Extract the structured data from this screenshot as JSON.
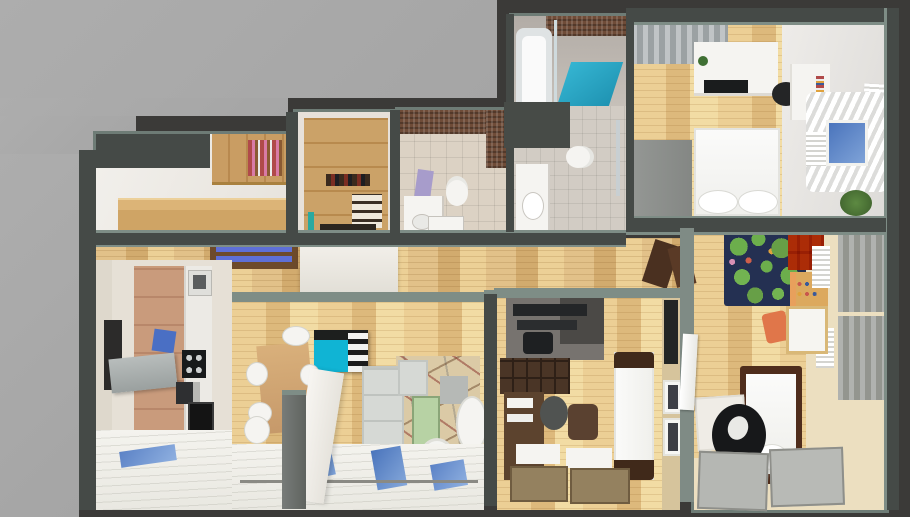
{
  "scene": {
    "title": "Apartment 3D floor plan render",
    "description": "Top-down dollhouse cutaway render of a furnished apartment on a two-tone gray backdrop",
    "projection": "top-down 3D cutaway",
    "image_width": 910,
    "image_height": 517
  },
  "palette": {
    "backdrop_light": "#a9a9a9",
    "backdrop_dark": "#3b3a38",
    "wall": "#454a47",
    "wall_top": "#7e8d86",
    "wood_floor": "#e4c68b",
    "tile_floor": "#d8d0c4",
    "carpet": "#ecdfc0",
    "accent_teal": "#14b2d2",
    "accent_blue": "#4a74bc",
    "accent_orange": "#d8773b",
    "rug_navy": "#243052",
    "sofa_gray": "#d5d8d4",
    "bed_frame_brown": "#4f2d1c",
    "green_table": "#b7d2a4",
    "mosaic_brown": "#6f4c38"
  },
  "rooms": [
    {
      "id": "entry-hall",
      "name": "Entry hall",
      "furniture": [
        "wooden bookshelf with books",
        "wooden sideboard",
        "white walls"
      ]
    },
    {
      "id": "walk-in-closet",
      "name": "Walk-in closet",
      "furniture": [
        "wardrobe shelving",
        "shoe shelves",
        "hanging clothes"
      ]
    },
    {
      "id": "bathroom-wc",
      "name": "Bathroom with WC and washer",
      "furniture": [
        "brown mosaic shower wall",
        "toilet",
        "washbasin counter",
        "washing machine",
        "lilac bath mat"
      ]
    },
    {
      "id": "bathroom-tub",
      "name": "Bathroom with tub and shower",
      "furniture": [
        "bathtub",
        "glass shower screen",
        "teal shower mat",
        "toilet",
        "washbasin counter"
      ]
    },
    {
      "id": "master-bedroom",
      "name": "Master bedroom",
      "furniture": [
        "gray wardrobe",
        "white dresser with TV",
        "double bed with pillows",
        "desk",
        "black chair",
        "window with blue sky and white curtains",
        "white radiator and blinds",
        "potted plant"
      ]
    },
    {
      "id": "kids-room",
      "name": "Kids room",
      "furniture": [
        "navy play rug with green trees",
        "orange toy cubby shelf",
        "activity table",
        "orange kids chair",
        "white kids table",
        "white radiators",
        "gray curtains",
        "single bed with brown frame",
        "desk",
        "black office chair",
        "two gray floor mats",
        "white open door"
      ]
    },
    {
      "id": "hallway",
      "name": "Hallway",
      "furniture": [
        "shoe bench with blue cushions",
        "white sideboard",
        "open brown door"
      ]
    },
    {
      "id": "kitchen",
      "name": "Kitchen",
      "furniture": [
        "tall dark fridge",
        "wood cabinet run",
        "counter with sink",
        "blue cutting board",
        "black cooktop",
        "gray range hood",
        "coffee machine",
        "black oven",
        "panorama window floor"
      ]
    },
    {
      "id": "living-room",
      "name": "Living room",
      "furniture": [
        "wooden dining table",
        "white dining chairs",
        "teal shelving unit with striped boxes",
        "white partition wall",
        "gray sectional sofa",
        "patterned rug",
        "green coffee table",
        "gray cube side table",
        "white armchair",
        "white pouf",
        "panorama window floor with sky reflections"
      ]
    },
    {
      "id": "study",
      "name": "Study / home office",
      "furniture": [
        "gray workout corner with black equipment",
        "black desk setup",
        "dark bookcase",
        "writing desk with papers",
        "gray desk chair",
        "brown ottoman",
        "white sofa bed with brown ends",
        "wall TV panel",
        "two picture frames",
        "window sills with tan rugs"
      ]
    }
  ]
}
